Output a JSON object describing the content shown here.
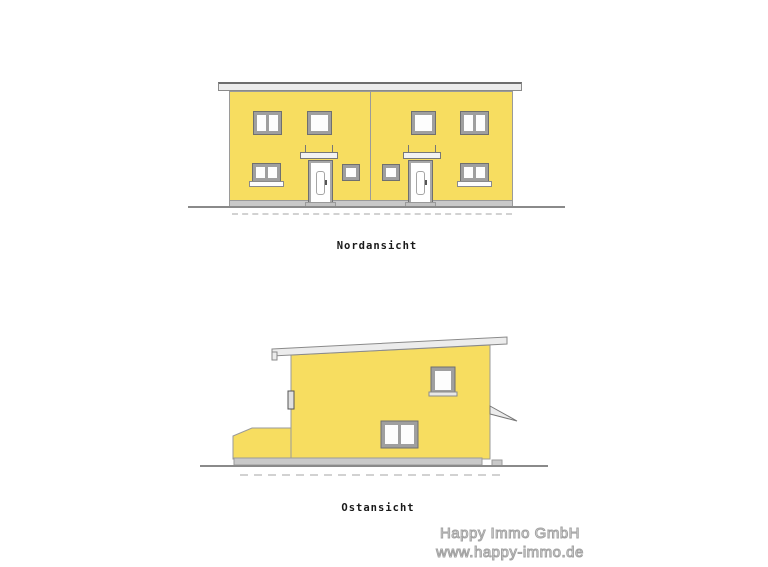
{
  "north_view": {
    "label": "Nordansicht"
  },
  "east_view": {
    "label": "Ostansicht"
  },
  "watermark": {
    "company": "Happy Immo GmbH",
    "website": "www.happy-immo.de"
  },
  "colors": {
    "facade_yellow": "#f7dd60",
    "roof_gray": "#ececec",
    "plinth_gray": "#c9c9c9",
    "window_frame_gray": "#9f9f9f",
    "ground_line_gray": "#8a8a8a",
    "label_black": "#1a1a1a",
    "watermark_gray": "#a2a2a2"
  }
}
